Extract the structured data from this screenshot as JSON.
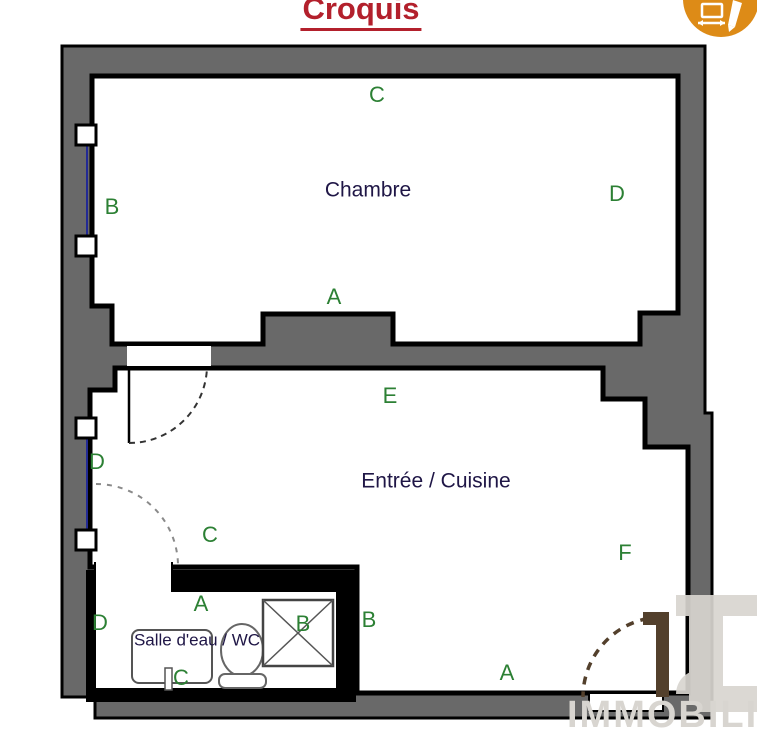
{
  "title": "Croquis",
  "rooms": {
    "chambre": {
      "name": "Chambre",
      "markers": {
        "a": "A",
        "b": "B",
        "c": "C",
        "d": "D"
      }
    },
    "entree_cuisine": {
      "name": "Entrée / Cuisine",
      "markers": {
        "a": "A",
        "b": "B",
        "c": "C",
        "d": "D",
        "e": "E",
        "f": "F"
      }
    },
    "salle_eau": {
      "name": "Salle d'eau / WC",
      "markers": {
        "a": "A",
        "b": "B",
        "c": "C",
        "d": "D"
      }
    }
  },
  "watermark": {
    "text": "IMMOBILI"
  },
  "icons": {
    "header_logo": "floor-plan-sketch-icon",
    "fixtures": [
      "sink-icon",
      "toilet-icon",
      "shower-icon"
    ]
  },
  "colors": {
    "title_red": "#b3202c",
    "wall_gray": "#696969",
    "marker_green": "#2c8034",
    "room_label_navy": "#1f1646",
    "window_blue": "#232a94",
    "door_brown": "#53402c",
    "logo_orange": "#dd8b17",
    "watermark_gray": "#d8d5d0"
  }
}
